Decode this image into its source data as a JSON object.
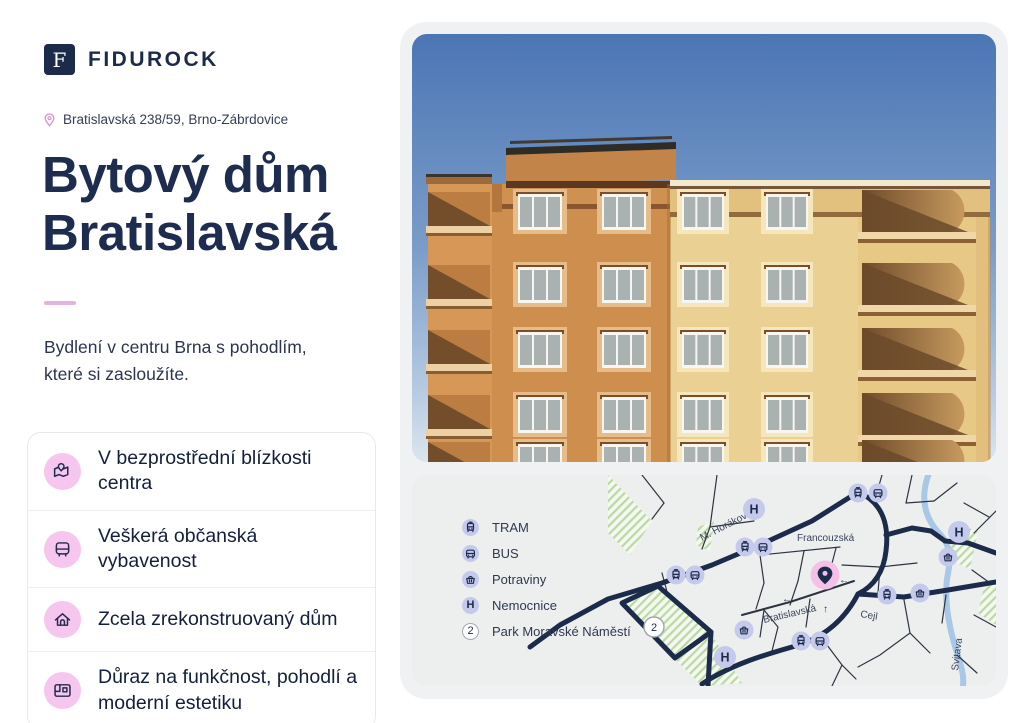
{
  "brand": {
    "name": "FIDUROCK",
    "logo_letter": "F"
  },
  "address": "Bratislavská 238/59, Brno-Zábrdovice",
  "title": {
    "line1": "Bytový dům",
    "line2": "Bratislavská"
  },
  "tagline": {
    "line1": "Bydlení v centru Brna s pohodlím,",
    "line2": "které si zasloužíte."
  },
  "features": {
    "items": [
      {
        "icon": "map-location-icon",
        "label": "V bezprostřední blízkosti centra"
      },
      {
        "icon": "bus-icon",
        "label": "Veškerá občanská vybavenost"
      },
      {
        "icon": "home-icon",
        "label": "Zcela zrekonstruovaný dům"
      },
      {
        "icon": "blueprint-icon",
        "label": "Důraz na funkčnost, pohodlí a moderní estetiku"
      }
    ]
  },
  "map": {
    "legend": {
      "items": [
        {
          "label": "TRAM"
        },
        {
          "label": "BUS"
        },
        {
          "label": "Potraviny"
        },
        {
          "label": "Nemocnice"
        },
        {
          "label": "Park Moravské Náměstí"
        }
      ]
    },
    "streets": {
      "horakove": "M. Horákové",
      "francouzska": "Francouzská",
      "bratislavska": "Bratislavská",
      "cejl": "Cejl",
      "river": "Svitava"
    },
    "hospital_letter": "H",
    "park_number": "2",
    "arrow_left": "←",
    "arrow_up": "↑"
  },
  "colors": {
    "navy": "#1d2b4a",
    "accent_pink": "#f3c1e8",
    "lavender": "#c5c9ec",
    "divider_pink": "#e3b2de"
  }
}
